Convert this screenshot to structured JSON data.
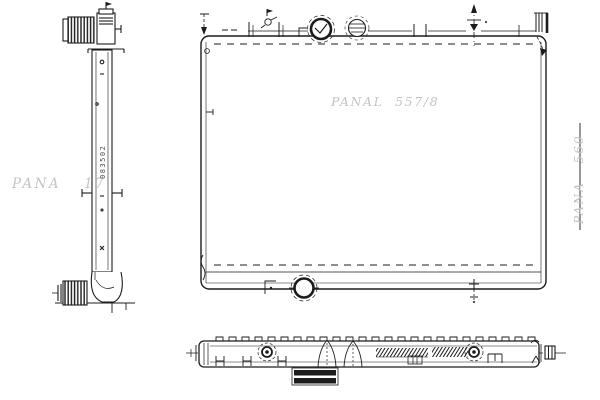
{
  "drawing": {
    "type": "radiator-technical-drawing",
    "colors": {
      "background": "#ffffff",
      "line": "#1c1c1c",
      "watermark": "#c4c4c4"
    },
    "watermarks": {
      "left": "PANA 17",
      "center": "PANAL 557/8",
      "right": "PANA 560"
    },
    "part_code_vertical": "083502",
    "views": {
      "side_view_label": "side-view",
      "front_view_label": "front-view",
      "bottom_view_label": "bottom-view"
    }
  }
}
